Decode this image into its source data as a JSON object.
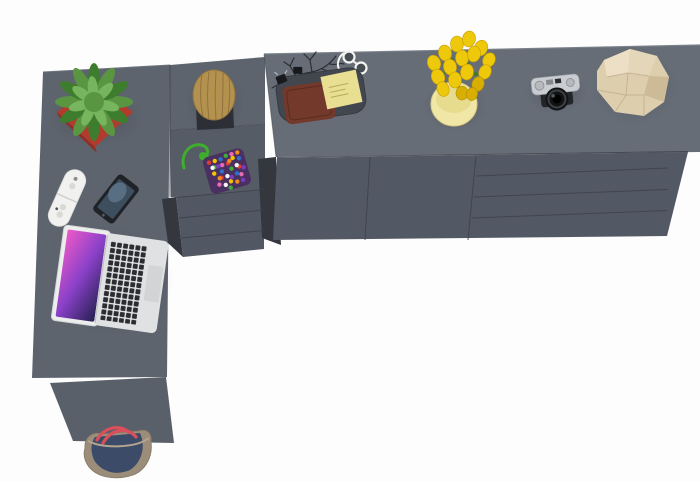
{
  "scene": {
    "title": "Top-down 3D render of a graphite L-shaped desk with drawer pedestal and long sideboard, decorated with accessories, on a white background",
    "background": "#fdfdfd"
  },
  "furniture": {
    "desk": {
      "label": "L-shaped desk top",
      "color": "#5e646e",
      "edge_highlight": "#6e747d"
    },
    "panel": {
      "label": "Desk side support panel",
      "color": "#5a606a"
    },
    "pedestal": {
      "label": "Desk drawer pedestal",
      "drawers": 3,
      "top_color": "#565c66",
      "front_color": "#525863"
    },
    "sideboard": {
      "label": "Sideboard cabinet",
      "doors": 2,
      "drawers": 4,
      "top_color": "#676d77",
      "front_color": "#535964",
      "top_edge_highlight": "#7b818a"
    },
    "seam_color": "#3d414a",
    "shadow_side_color": "#34373e"
  },
  "items": {
    "plant": {
      "label": "Succulent plant in red cube pot",
      "pot_color": "#b23b2e",
      "pot_shade": "#8f2f26",
      "leaf_color": "#5a9642",
      "leaf_dark": "#3f7d2e",
      "leaf_light": "#79b860"
    },
    "stool": {
      "label": "Wooden log stool on dark base",
      "wood_color": "#b3914f",
      "wood_streak": "#8a6b39",
      "base_color": "#2c2f35"
    },
    "pouch": {
      "label": "Bead-covered pouch on green cord",
      "cord_color": "#3fae2e",
      "base_color": "#4a3060",
      "bead_colors": [
        "#e23c32",
        "#f4c400",
        "#2f6fd0",
        "#3faa35",
        "#e86bb0",
        "#f08c1e",
        "#f4f4f4",
        "#7a3bc0"
      ]
    },
    "branches": {
      "label": "Dark decorative twigs",
      "color": "#2b2e33"
    },
    "glasses": {
      "label": "White folded eyeglasses",
      "frame_color": "#f4f4f2"
    },
    "tray": {
      "label": "Desk valet tray",
      "color": "#42464e"
    },
    "wallet": {
      "label": "Brown leather wallet",
      "color": "#73392a",
      "stitch_color": "#5a2c20"
    },
    "sticky_notes": {
      "label": "Yellow sticky note pad",
      "color": "#e9df93",
      "ink_color": "#b9ab57"
    },
    "clips": {
      "label": "Black binder clips",
      "color": "#17191c"
    },
    "tulips": {
      "label": "Bouquet of yellow tulips",
      "flower_color": "#eec80a",
      "flower_dark": "#d9ae03",
      "stem_color": "#3c7a2a"
    },
    "vase": {
      "label": "Cream cylinder vase",
      "color": "#f0e6a6",
      "inner_color": "#e6d98c"
    },
    "camera": {
      "label": "Vintage rangefinder camera",
      "plate_color": "#c9ccd0",
      "body_color": "#232528",
      "lens_color": "#121315"
    },
    "stone": {
      "label": "Beige faceted stone sculpture",
      "color": "#ddcfae",
      "facet_light": "#ecdfc5",
      "facet_mid": "#e4d6b8",
      "facet_dark": "#cdbb97",
      "edge_color": "#c2ae8e"
    },
    "controllers": {
      "label": "Pair of white game remotes",
      "color": "#f1f1ef",
      "button_color": "#d9d9d5"
    },
    "phone": {
      "label": "Smartphone with lit screen",
      "body_color": "#1f2226",
      "screen_color": "#3d4e5e"
    },
    "laptop": {
      "label": "Open silver laptop",
      "body_color": "#dfe1e3",
      "bezel_color": "#eceded",
      "key_color": "#2b2d30",
      "trackpad_color": "#d2d4d6",
      "screen_colors": [
        "#ee59c8",
        "#8a41c9",
        "#262050"
      ]
    },
    "bag": {
      "label": "Canvas tote bag",
      "body_color": "#9b8d79",
      "panel_color": "#3c4b67",
      "strap_color": "#d9505c",
      "rim_color": "#b3a58f"
    }
  }
}
